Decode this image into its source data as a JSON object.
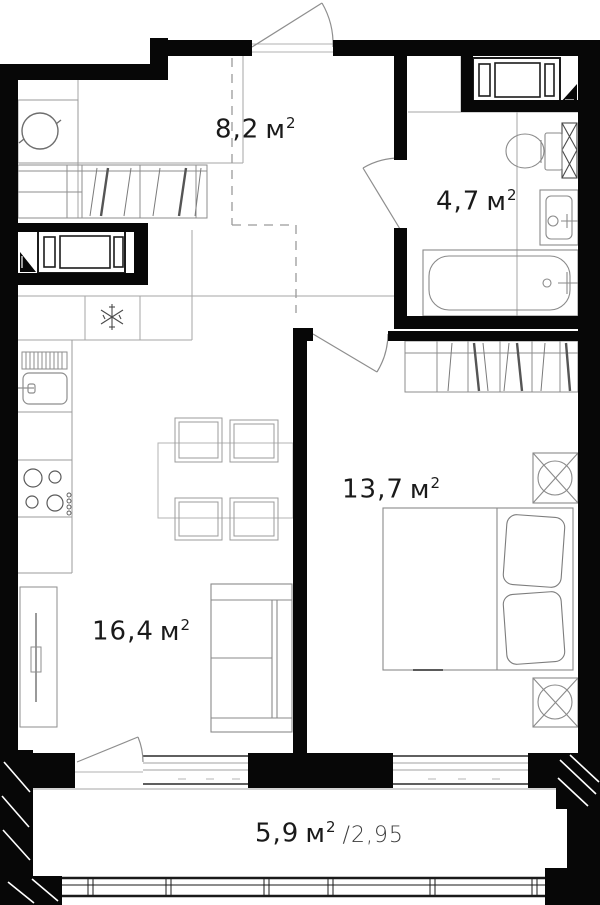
{
  "colors": {
    "wall": "#070707",
    "thin_line": "#a6a6a6",
    "furniture_line": "#8e8e8e",
    "appliance_line": "#1c1c1c",
    "text": "#1a1a1a",
    "text_secondary": "#3d3d3d",
    "background": "#ffffff"
  },
  "rooms": {
    "hallway": {
      "area_value": "8,2",
      "area_unit": "м",
      "area_sup": "2"
    },
    "bathroom": {
      "area_value": "4,7",
      "area_unit": "м",
      "area_sup": "2"
    },
    "bedroom": {
      "area_value": "13,7",
      "area_unit": "м",
      "area_sup": "2"
    },
    "living": {
      "area_value": "16,4",
      "area_unit": "м",
      "area_sup": "2"
    },
    "balcony": {
      "area_value": "5,9",
      "area_unit": "м",
      "area_sup": "2",
      "coefficient": "/2,95"
    }
  },
  "furniture_icons": {
    "hallway": [
      "closet-cabinet-icon",
      "rotation-circle-icon",
      "wardrobe-hangers-icon",
      "washing-machine-icon"
    ],
    "bathroom": [
      "washing-machine-icon",
      "toilet-icon",
      "vent-shaft-icon",
      "washbasin-icon",
      "bathtub-icon"
    ],
    "kitchen": [
      "fridge-snowflake-icon",
      "dish-drainer-icon",
      "kitchen-sink-icon",
      "stove-burners-icon",
      "dining-table-icon",
      "chair-icon"
    ],
    "living": [
      "tv-stand-icon",
      "sofa-icon"
    ],
    "bedroom": [
      "wardrobe-hangers-icon",
      "bed-icon",
      "nightstand-cross-icon"
    ],
    "openings": [
      "entrance-door-swing",
      "bathroom-door-swing",
      "bedroom-door-swing",
      "balcony-door-swing",
      "window",
      "balcony-glazing"
    ]
  }
}
